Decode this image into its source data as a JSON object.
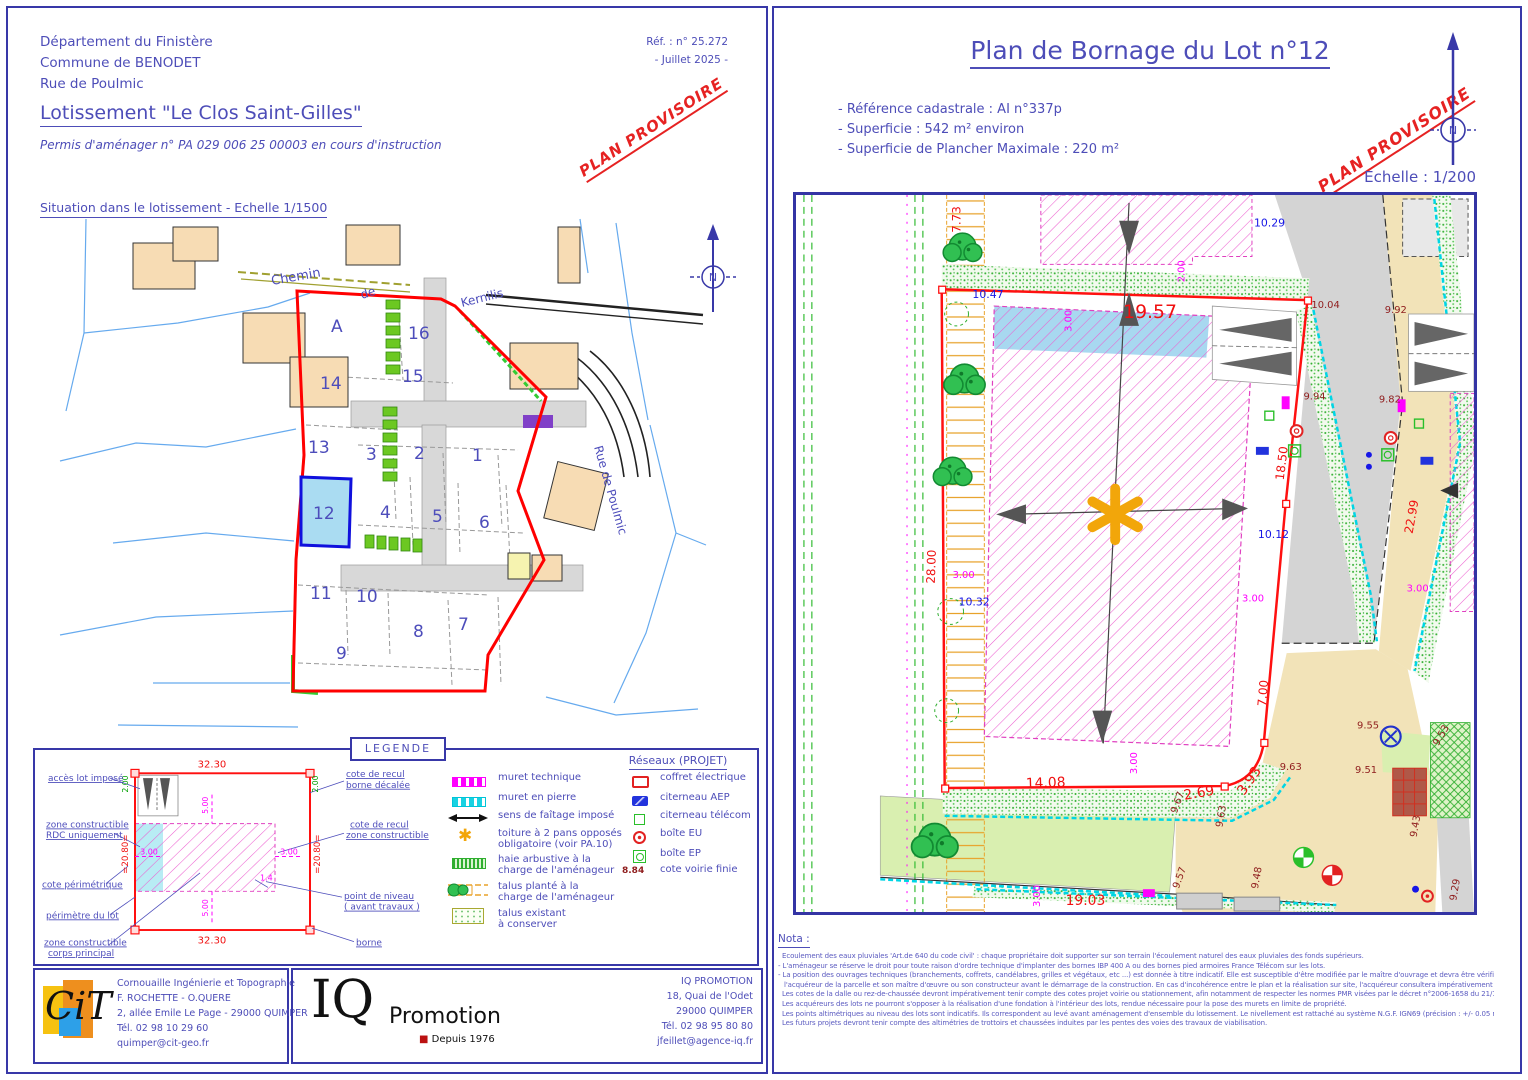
{
  "header_left": {
    "line1": "Département du Finistère",
    "line2": "Commune de BENODET",
    "line3": "Rue de Poulmic"
  },
  "ref_block": {
    "ref": "Réf. : n° 25.272",
    "date": "- Juillet 2025 -"
  },
  "stamp": "PLAN PROVISOIRE",
  "project": {
    "title": "Lotissement \"Le Clos Saint-Gilles\"",
    "permit": "Permis d'aménager n° PA 029 006 25 00003 en cours d'instruction",
    "situation_title": "Situation dans le lotissement - Echelle 1/1500"
  },
  "situation_map": {
    "streets": [
      {
        "t": "Chemin",
        "x": 214,
        "y": 70,
        "c": "li",
        "s": 13,
        "r": -10,
        "n": "street-label"
      },
      {
        "t": "de",
        "x": 304,
        "y": 84,
        "c": "li",
        "s": 12,
        "r": -18,
        "n": "street-label"
      },
      {
        "t": "Kernilis",
        "x": 404,
        "y": 92,
        "c": "li",
        "s": 12,
        "r": -14,
        "n": "street-label"
      },
      {
        "t": "Rue de Poulmic",
        "x": 536,
        "y": 232,
        "c": "li",
        "s": 12,
        "r": 74,
        "n": "street-label"
      }
    ],
    "lots": [
      {
        "t": "A",
        "x": 273,
        "y": 117,
        "c": "li",
        "s": 17,
        "n": "lot-number"
      },
      {
        "t": "16",
        "x": 350,
        "y": 124,
        "c": "li",
        "s": 17,
        "n": "lot-number"
      },
      {
        "t": "14",
        "x": 262,
        "y": 174,
        "c": "li",
        "s": 17,
        "n": "lot-number"
      },
      {
        "t": "15",
        "x": 344,
        "y": 167,
        "c": "li",
        "s": 17,
        "n": "lot-number"
      },
      {
        "t": "13",
        "x": 250,
        "y": 238,
        "c": "li",
        "s": 17,
        "n": "lot-number"
      },
      {
        "t": "3",
        "x": 308,
        "y": 245,
        "c": "li",
        "s": 17,
        "n": "lot-number"
      },
      {
        "t": "2",
        "x": 356,
        "y": 244,
        "c": "li",
        "s": 17,
        "n": "lot-number"
      },
      {
        "t": "1",
        "x": 414,
        "y": 246,
        "c": "li",
        "s": 17,
        "n": "lot-number"
      },
      {
        "t": "12",
        "x": 255,
        "y": 304,
        "c": "li",
        "s": 17,
        "n": "lot-number-highlight"
      },
      {
        "t": "4",
        "x": 322,
        "y": 303,
        "c": "li",
        "s": 17,
        "n": "lot-number"
      },
      {
        "t": "5",
        "x": 374,
        "y": 307,
        "c": "li",
        "s": 17,
        "n": "lot-number"
      },
      {
        "t": "6",
        "x": 421,
        "y": 313,
        "c": "li",
        "s": 17,
        "n": "lot-number"
      },
      {
        "t": "11",
        "x": 252,
        "y": 384,
        "c": "li",
        "s": 17,
        "n": "lot-number"
      },
      {
        "t": "10",
        "x": 298,
        "y": 387,
        "c": "li",
        "s": 17,
        "n": "lot-number"
      },
      {
        "t": "9",
        "x": 278,
        "y": 444,
        "c": "li",
        "s": 17,
        "n": "lot-number"
      },
      {
        "t": "8",
        "x": 355,
        "y": 422,
        "c": "li",
        "s": 17,
        "n": "lot-number"
      },
      {
        "t": "7",
        "x": 400,
        "y": 415,
        "c": "li",
        "s": 17,
        "n": "lot-number"
      }
    ]
  },
  "main_plan": {
    "title": "Plan de Bornage du Lot n°12",
    "info_lines": [
      "- Référence cadastrale : AI n°337p",
      "- Superficie : 542 m² environ",
      "- Superficie de Plancher Maximale : 220 m²"
    ],
    "scale": "Echelle : 1/200",
    "north": "N",
    "labels": [
      {
        "t": "7.73",
        "x": 166,
        "y": 38,
        "c": "lr",
        "s": 12,
        "r": -90
      },
      {
        "t": "10.29",
        "x": 462,
        "y": 32,
        "c": "lb",
        "s": 11
      },
      {
        "t": "2.00",
        "x": 392,
        "y": 88,
        "c": "lm",
        "s": 10,
        "r": -90
      },
      {
        "t": "10.47",
        "x": 178,
        "y": 104,
        "c": "lb",
        "s": 11
      },
      {
        "t": "19.57",
        "x": 330,
        "y": 124,
        "c": "lr",
        "s": 19
      },
      {
        "t": "3.00",
        "x": 278,
        "y": 138,
        "c": "lm",
        "s": 10,
        "r": -90
      },
      {
        "t": "10.04",
        "x": 520,
        "y": 114,
        "c": "ld",
        "s": 10
      },
      {
        "t": "9.92",
        "x": 594,
        "y": 119,
        "c": "ld",
        "s": 10
      },
      {
        "t": "9.94",
        "x": 512,
        "y": 206,
        "c": "ld",
        "s": 10
      },
      {
        "t": "9.82",
        "x": 588,
        "y": 209,
        "c": "ld",
        "s": 10
      },
      {
        "t": "18.50",
        "x": 492,
        "y": 288,
        "c": "lr",
        "s": 12,
        "r": -83
      },
      {
        "t": "22.99",
        "x": 622,
        "y": 342,
        "c": "lr",
        "s": 12,
        "r": -80
      },
      {
        "t": "10.12",
        "x": 466,
        "y": 346,
        "c": "lb",
        "s": 11
      },
      {
        "t": "28.00",
        "x": 140,
        "y": 392,
        "c": "lr",
        "s": 12,
        "r": -88
      },
      {
        "t": "3.00",
        "x": 158,
        "y": 386,
        "c": "lm",
        "s": 10
      },
      {
        "t": "10.32",
        "x": 164,
        "y": 414,
        "c": "lb",
        "s": 11
      },
      {
        "t": "3.00",
        "x": 450,
        "y": 410,
        "c": "lm",
        "s": 10
      },
      {
        "t": "3.00",
        "x": 616,
        "y": 400,
        "c": "lm",
        "s": 10
      },
      {
        "t": "7.00",
        "x": 474,
        "y": 516,
        "c": "lr",
        "s": 12,
        "r": -85
      },
      {
        "t": "9.55",
        "x": 566,
        "y": 538,
        "c": "ld",
        "s": 10
      },
      {
        "t": "9.53",
        "x": 648,
        "y": 556,
        "c": "ld",
        "s": 10,
        "r": -60
      },
      {
        "t": "9.63",
        "x": 488,
        "y": 580,
        "c": "ld",
        "s": 10
      },
      {
        "t": "9.51",
        "x": 564,
        "y": 583,
        "c": "ld",
        "s": 10
      },
      {
        "t": "14.08",
        "x": 232,
        "y": 598,
        "c": "lr",
        "s": 14,
        "r": -2
      },
      {
        "t": "2.69",
        "x": 392,
        "y": 610,
        "c": "lr",
        "s": 14,
        "r": -10
      },
      {
        "t": "3.93",
        "x": 452,
        "y": 606,
        "c": "lr",
        "s": 14,
        "r": -55
      },
      {
        "t": "3.00",
        "x": 344,
        "y": 584,
        "c": "lm",
        "s": 10,
        "r": -90
      },
      {
        "t": "9.67",
        "x": 384,
        "y": 624,
        "c": "ld",
        "s": 10,
        "r": -70
      },
      {
        "t": "9.63",
        "x": 430,
        "y": 638,
        "c": "ld",
        "s": 10,
        "r": -80
      },
      {
        "t": "9.43",
        "x": 626,
        "y": 648,
        "c": "ld",
        "s": 10,
        "r": -80
      },
      {
        "t": "9.57",
        "x": 386,
        "y": 700,
        "c": "ld",
        "s": 10,
        "r": -70
      },
      {
        "t": "9.48",
        "x": 466,
        "y": 700,
        "c": "ld",
        "s": 10,
        "r": -80
      },
      {
        "t": "9.29",
        "x": 666,
        "y": 712,
        "c": "ld",
        "s": 10,
        "r": -80
      },
      {
        "t": "19.03",
        "x": 272,
        "y": 716,
        "c": "lr",
        "s": 14
      },
      {
        "t": "3.00",
        "x": 246,
        "y": 718,
        "c": "lm",
        "s": 10,
        "r": -90
      }
    ]
  },
  "legend": {
    "title": "LEGENDE",
    "diagram_labels": [
      {
        "t": "32.30",
        "x": 172,
        "y": 16,
        "c": "lr",
        "s": 10,
        "a": "middle"
      },
      {
        "t": "32.30",
        "x": 172,
        "y": 198,
        "c": "lr",
        "s": 10,
        "a": "middle"
      },
      {
        "t": "2.00",
        "x": 88,
        "y": 42,
        "c": "lg",
        "s": 8,
        "r": -90
      },
      {
        "t": "2.00",
        "x": 278,
        "y": 42,
        "c": "lg",
        "s": 8,
        "r": -90
      },
      {
        "t": "5.00",
        "x": 168,
        "y": 64,
        "c": "lm",
        "s": 8,
        "r": -90
      },
      {
        "t": "5.00",
        "x": 168,
        "y": 170,
        "c": "lm",
        "s": 8,
        "r": -90
      },
      {
        "t": "=20.80=",
        "x": 88,
        "y": 126,
        "c": "lr",
        "s": 9,
        "r": -90
      },
      {
        "t": "=20.80=",
        "x": 280,
        "y": 126,
        "c": "lr",
        "s": 9,
        "r": -90
      },
      {
        "t": "3.00",
        "x": 109,
        "y": 106,
        "c": "lm",
        "s": 8,
        "a": "middle"
      },
      {
        "t": "3.00",
        "x": 249,
        "y": 106,
        "c": "lm",
        "s": 8,
        "a": "middle"
      },
      {
        "t": "1.4",
        "x": 220,
        "y": 133,
        "c": "lm",
        "s": 8
      },
      {
        "t": "accès lot imposé",
        "x": 8,
        "y": 30,
        "c": "lc",
        "s": 9
      },
      {
        "t": "zone constructible",
        "x": 6,
        "y": 78,
        "c": "lc",
        "s": 9
      },
      {
        "t": "RDC uniquement",
        "x": 6,
        "y": 89,
        "c": "lc",
        "s": 9
      },
      {
        "t": "cote périmétrique",
        "x": 2,
        "y": 140,
        "c": "lc",
        "s": 9
      },
      {
        "t": "périmètre du lot",
        "x": 6,
        "y": 172,
        "c": "lc",
        "s": 9
      },
      {
        "t": "zone constructible",
        "x": 4,
        "y": 200,
        "c": "lc",
        "s": 9
      },
      {
        "t": "corps principal",
        "x": 8,
        "y": 211,
        "c": "lc",
        "s": 9
      },
      {
        "t": "cote de recul",
        "x": 306,
        "y": 26,
        "c": "lc",
        "s": 9
      },
      {
        "t": "borne décalée",
        "x": 306,
        "y": 37,
        "c": "lc",
        "s": 9
      },
      {
        "t": "cote de recul",
        "x": 310,
        "y": 78,
        "c": "lc",
        "s": 9
      },
      {
        "t": "zone constructible",
        "x": 306,
        "y": 89,
        "c": "lc",
        "s": 9
      },
      {
        "t": "point de niveau",
        "x": 304,
        "y": 152,
        "c": "lc",
        "s": 9
      },
      {
        "t": "( avant travaux )",
        "x": 304,
        "y": 163,
        "c": "lc",
        "s": 9
      },
      {
        "t": "borne",
        "x": 316,
        "y": 200,
        "c": "lc",
        "s": 9
      }
    ],
    "symbol_rows": [
      {
        "label": "muret technique"
      },
      {
        "label": "muret en pierre"
      },
      {
        "label": "sens de faîtage imposé"
      },
      {
        "label": "toiture à 2 pans opposés",
        "label2": "obligatoire (voir PA.10)"
      },
      {
        "label": "haie arbustive à la",
        "label2": "charge de l'aménageur"
      },
      {
        "label": "talus planté à la",
        "label2": "charge de l'aménageur"
      },
      {
        "label": "talus existant",
        "label2": "à conserver"
      }
    ],
    "networks": {
      "title": "Réseaux (PROJET)",
      "rows": [
        {
          "label": "coffret électrique"
        },
        {
          "label": "citerneau AEP"
        },
        {
          "label": "citerneau télécom"
        },
        {
          "label": "boîte EU"
        },
        {
          "label": "boîte EP"
        },
        {
          "value": "8.84",
          "label": "cote voirie finie"
        }
      ]
    }
  },
  "footer": {
    "cit": {
      "logo": "CiT",
      "lines": [
        "Cornouaille Ingénierie et Topographie",
        "F. ROCHETTE - O.QUERE",
        "2, allée Emile Le Page - 29000 QUIMPER",
        "Tél. 02 98 10 29 60",
        "quimper@cit-geo.fr"
      ]
    },
    "iq": {
      "logo_main": "IQ",
      "logo_sub": "Promotion",
      "logo_tag": "Depuis 1976",
      "lines": [
        "IQ PROMOTION",
        "18, Quai de l'Odet",
        "29000 QUIMPER",
        "Tél. 02 98 95 80 80",
        "jfeillet@agence-iq.fr"
      ]
    }
  },
  "nota": {
    "title": "Nota :",
    "lines": [
      "Ecoulement des eaux pluviales 'Art.de 640 du code civil' : chaque propriétaire doit supporter sur son terrain l'écoulement naturel des eaux pluviales des fonds supérieurs.",
      "- L'aménageur se réserve le droit pour toute raison d'ordre technique d'implanter des bornes IBP 400 A ou des bornes pied armoires France Télécom sur les lots.",
      "- La position des ouvrages techniques (branchements, coffrets, candélabres, grilles et végétaux, etc ...) est donnée à titre indicatif. Elle est susceptible d'être modifiée par le maître d'ouvrage et devra être vérifiée par",
      "l'acquéreur de la parcelle et son maître d'œuvre ou son constructeur avant le démarrage de la construction. En cas d'incohérence entre le plan et la réalisation sur site, l'acquéreur consultera impérativement l'aménageur.",
      "Les cotes de la dalle ou rez-de-chaussée devront impérativement tenir compte des cotes projet voirie ou stationnement, afin notamment de respecter les normes PMR visées par le décret n°2006-1658 du 21/12/2006.",
      "Les acquéreurs des lots ne pourront s'opposer à la réalisation d'une fondation à l'intérieur des lots, rendue nécessaire pour la pose des murets en limite de propriété.",
      "Les points altimétriques au niveau des lots sont indicatifs. Ils correspondent au levé avant aménagement d'ensemble du lotissement. Le nivellement est rattaché au système N.G.F. IGN69 (précision : +/- 0.05 m).",
      "Les futurs projets devront tenir compte des altimétries de trottoirs et chaussées induites par les pentes des voies des travaux de viabilisation."
    ]
  }
}
